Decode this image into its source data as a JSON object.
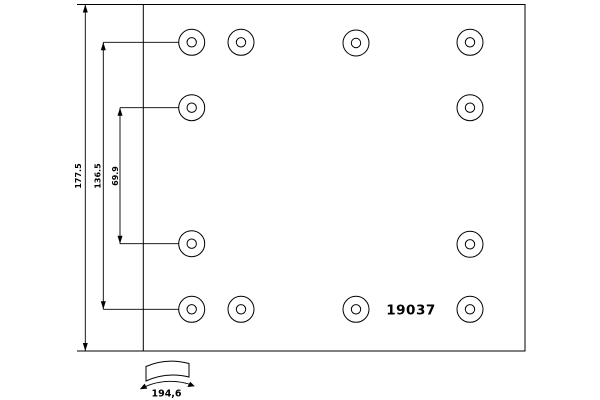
{
  "drawing": {
    "part_number": "19037",
    "dimensions": {
      "overall_height": "177.5",
      "outer_hole_span": "136.5",
      "inner_hole_span": "69.9",
      "arc_width": "194,6"
    },
    "hole_outer_radius": 13,
    "hole_inner_radius": 4.7,
    "holes": [
      {
        "x": 191.7,
        "y": 42.3
      },
      {
        "x": 241.0,
        "y": 42.3
      },
      {
        "x": 356.0,
        "y": 43.0
      },
      {
        "x": 470.0,
        "y": 42.3
      },
      {
        "x": 191.7,
        "y": 107.7
      },
      {
        "x": 470.0,
        "y": 107.7
      },
      {
        "x": 191.7,
        "y": 243.7
      },
      {
        "x": 470.0,
        "y": 244.3
      },
      {
        "x": 191.7,
        "y": 309.3
      },
      {
        "x": 241.0,
        "y": 309.3
      },
      {
        "x": 356.0,
        "y": 309.3
      },
      {
        "x": 470.0,
        "y": 309.3
      }
    ],
    "colors": {
      "line": "#000000",
      "background": "#ffffff"
    }
  }
}
